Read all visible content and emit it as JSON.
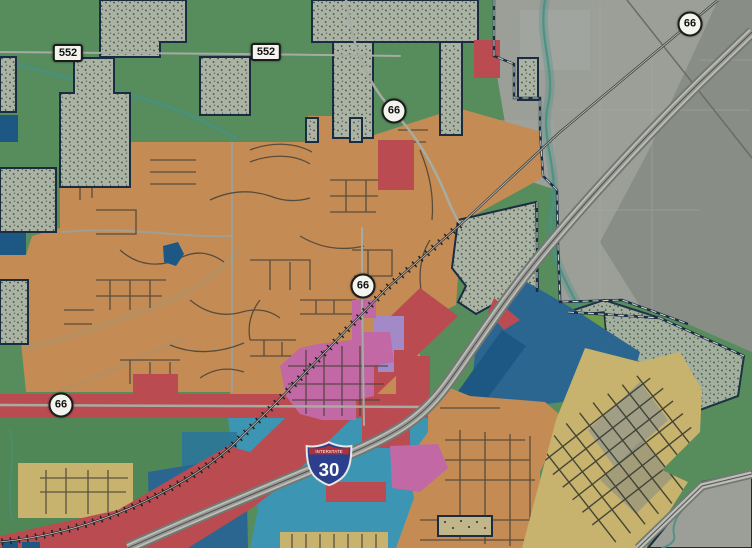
{
  "map": {
    "type": "municipal zoning map over aerial imagery",
    "markers": [
      {
        "id": "route-552-west",
        "kind": "state-rect",
        "label": "552"
      },
      {
        "id": "route-552-east",
        "kind": "state-rect",
        "label": "552"
      },
      {
        "id": "route-66-north",
        "kind": "highway-circle",
        "label": "66"
      },
      {
        "id": "route-66-northeast",
        "kind": "highway-circle",
        "label": "66"
      },
      {
        "id": "route-66-center",
        "kind": "highway-circle",
        "label": "66"
      },
      {
        "id": "route-66-west",
        "kind": "highway-circle",
        "label": "66"
      },
      {
        "id": "interstate-30",
        "kind": "interstate-shield",
        "banner": "INTERSTATE",
        "label": "30"
      }
    ],
    "palette": {
      "green": "#5d9661",
      "green-dark": "#55915b",
      "green-bright": "#72a74e",
      "aerial": "#a6aaa2",
      "aerial-dark": "#8d928b",
      "stipple": "#b7c0b0",
      "stipple-dot": "#46543f",
      "orange": "#d29659",
      "red": "#c85055",
      "teal": "#3fa0bf",
      "teal-dark": "#2f7fa3",
      "slate-blue": "#2e6d99",
      "navy": "#1f5d8b",
      "pink": "#cf6fb0",
      "lavender": "#ae93d4",
      "tan": "#d6bf75",
      "boundary": "#1a2f45",
      "street": "#4b463b",
      "creek": "#4e9b8c",
      "shield-bg": "#f4f4ee",
      "interstate-blue": "#2b3f8c",
      "interstate-red": "#b03038"
    }
  }
}
